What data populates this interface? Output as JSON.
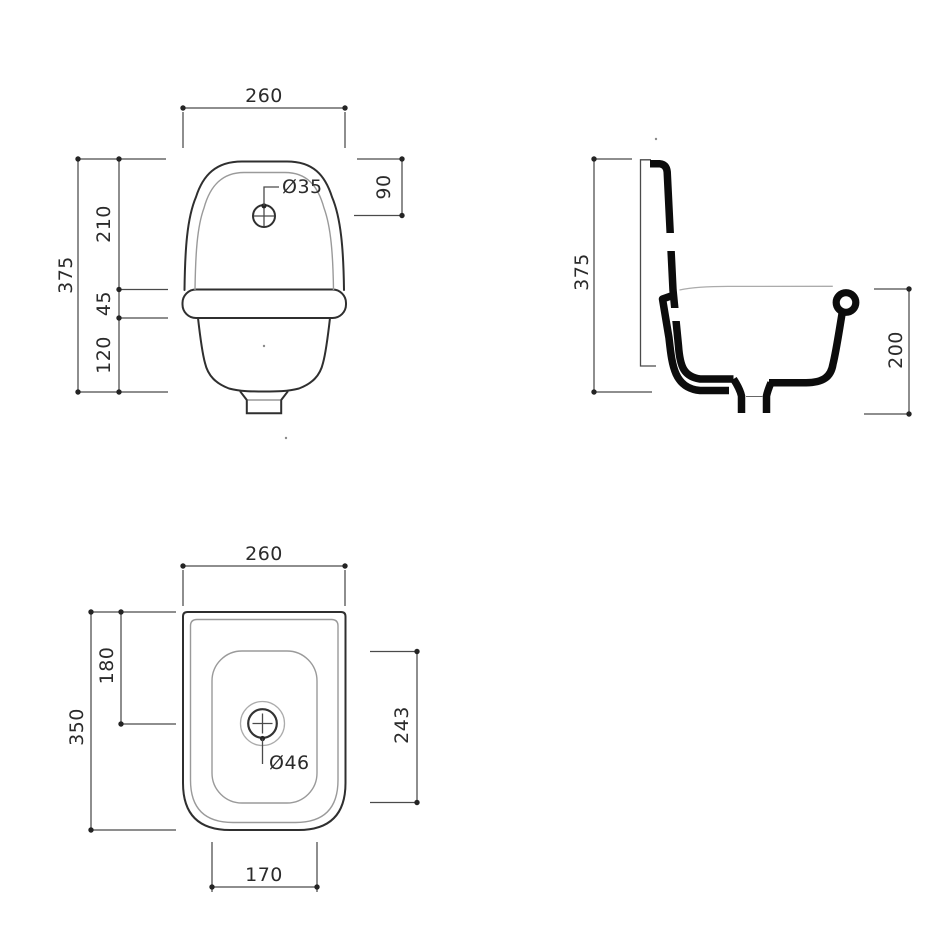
{
  "drawing": {
    "background": "#ffffff",
    "colors": {
      "outline": "#2f2f2f",
      "cross_section": "#0c0c0c",
      "inner_line": "#9a9a9a",
      "dimension_line": "#4a4a4a",
      "label_text": "#2b2b2b"
    },
    "views": {
      "front": {
        "name": "front-elevation",
        "width": "260",
        "tap_hole_offset": "90",
        "upper_height": "210",
        "rim_height": "45",
        "lower_height": "120",
        "total_height": "375",
        "tap_hole_diameter": "Ø35"
      },
      "side": {
        "name": "side-section",
        "total_height": "375",
        "bowl_depth": "200"
      },
      "plan": {
        "name": "plan-view",
        "width": "260",
        "drain_offset": "180",
        "total_depth": "350",
        "bowl_depth": "243",
        "drain_diameter": "Ø46",
        "bowl_width": "170"
      }
    }
  }
}
